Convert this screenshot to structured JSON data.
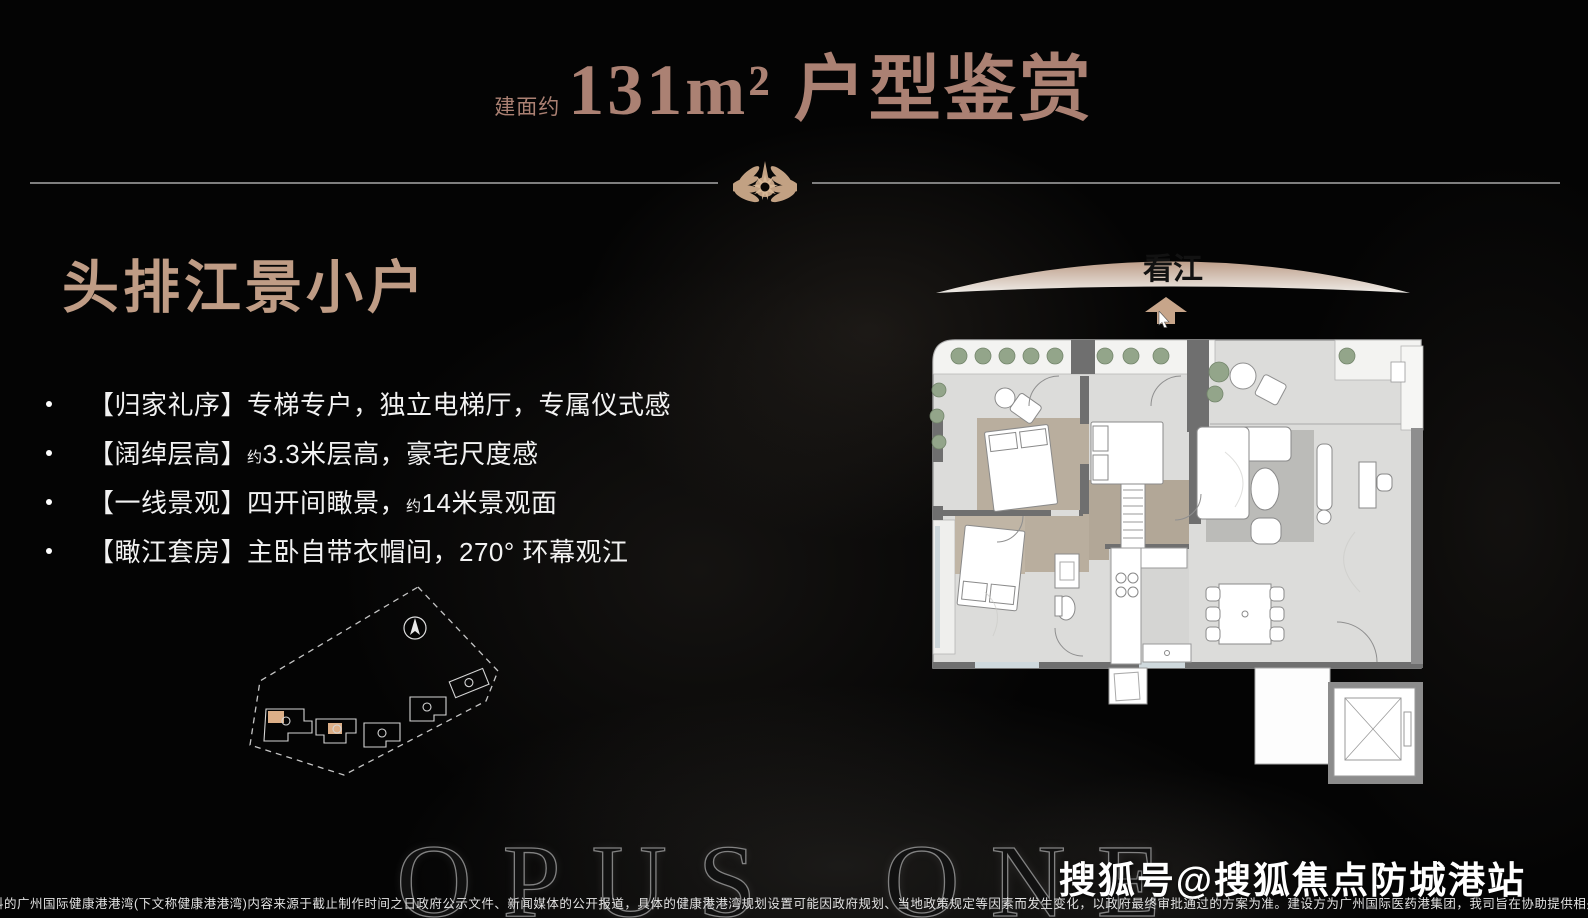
{
  "colors": {
    "background": "#040404",
    "title_accent": "#ab8173",
    "heading_accent": "#bf9c85",
    "body_text": "#f2f2f2",
    "divider_gray": "#7f7f7f",
    "arc_tan": "#bd9e89",
    "arrow_tan": "#c7a58a",
    "emblem_tan": "#c2a183",
    "plan_floor": "#dcdcda",
    "plan_wall": "#6f6f6f",
    "plan_wood": "#b9ae9e",
    "plant_green": "#93a58a"
  },
  "header": {
    "area_prefix": "建面约",
    "title": "131m² 户型鉴赏"
  },
  "hero": {
    "heading": "头排江景小户",
    "bullets": [
      {
        "tag": "【归家礼序】",
        "rest": "专梯专户，独立电梯厅，专属仪式感"
      },
      {
        "tag": "【阔绰层高】",
        "approx": "约",
        "rest": "3.3米层高，豪宅尺度感"
      },
      {
        "tag": "【一线景观】",
        "pre": "四开间瞰景，",
        "approx": "约",
        "rest": "14米景观面"
      },
      {
        "tag": "【瞰江套房】",
        "rest": "主卧自带衣帽间，270° 环幕观江"
      }
    ]
  },
  "floor_plan": {
    "view_label": "看江"
  },
  "watermarks": {
    "brand": "OPUS ONE",
    "sohu": "搜狐号@搜狐焦点防城港站"
  },
  "footer": {
    "disclaimer": "料的广州国际健康港港湾(下文称健康港港湾)内容来源于截止制作时间之日政府公示文件、新闻媒体的公开报道，具体的健康港港湾规划设置可能因政府规划、当地政策规定等因素而发生变化，以政府最终审批通过的方案为准。建设方为广州国际医药港集团，我司旨在协助提供相关信息，不承诺实施进度及效果，最终以双方签订的《商品房买卖合同》及其附件、补充协议约定和实际交付为准。"
  }
}
